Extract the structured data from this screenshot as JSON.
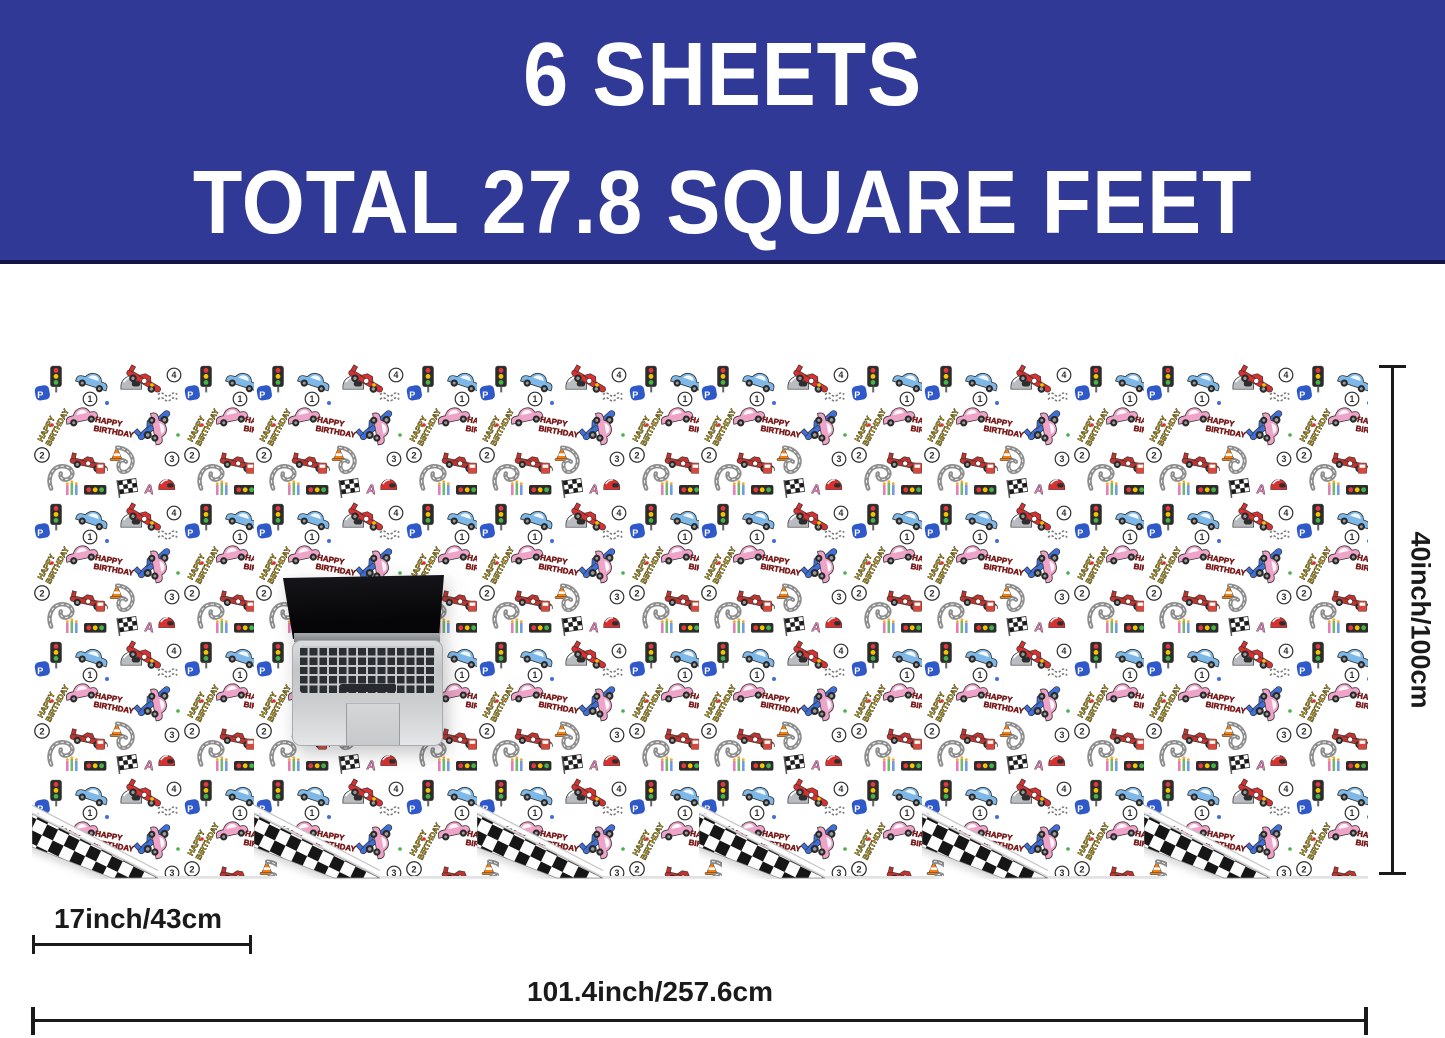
{
  "banner": {
    "line1": "6 SHEETS",
    "line2": "TOTAL 27.8 SQUARE FEET",
    "background_color": "#303a96",
    "text_color": "#ffffff"
  },
  "sheets": {
    "count": 6,
    "paper_background": "#ffffff",
    "back_side_pattern": "black-white checkerboard fold",
    "motifs": [
      "race-car",
      "classic-car",
      "racing-helmet",
      "traffic-light",
      "race-track-curve",
      "checkered-flag",
      "traffic-cone",
      "tire-tracks",
      "fuel-pump",
      "birthday-candles",
      "lap-number-badge",
      "happy-birthday-lettering"
    ]
  },
  "pattern_text": {
    "happy": "HAPPY",
    "birthday": "BIRTHDAY",
    "num1": "1",
    "num2": "2",
    "num3": "3",
    "num4": "4",
    "letter_p": "P",
    "letter_a": "A"
  },
  "dimensions": {
    "sheet_height_label": "40inch/100cm",
    "sheet_width_label": "17inch/43cm",
    "total_width_label": "101.4inch/257.6cm",
    "line_color": "#1a1a1a"
  },
  "scale_reference": {
    "object": "laptop"
  }
}
